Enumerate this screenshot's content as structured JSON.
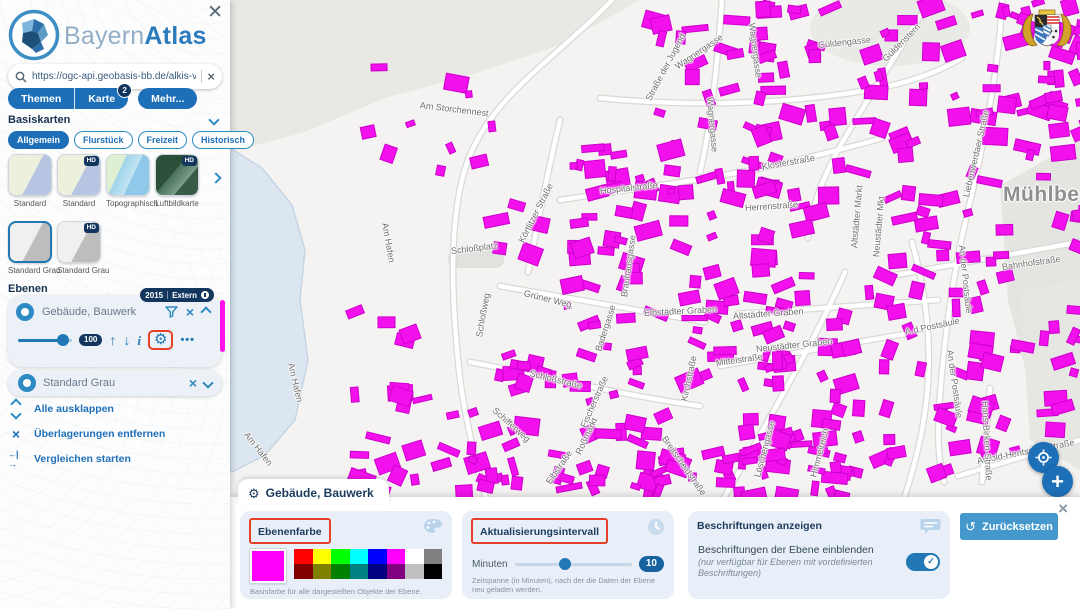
{
  "brand": {
    "bayern": "Bayern",
    "atlas": "Atlas"
  },
  "sidebar": {
    "search": {
      "value": "https://ogc-api.geobasis-bb.de/alkis-verein"
    },
    "tabs": [
      {
        "label": "Themen"
      },
      {
        "label": "Karte",
        "badge": "2"
      },
      {
        "label": "Mehr..."
      }
    ],
    "basiskarten": {
      "title": "Basiskarten",
      "hd": "HD",
      "chips": [
        "Allgemein",
        "Flurstück",
        "Freizeit",
        "Historisch"
      ],
      "thumbs": [
        {
          "label": "Standard"
        },
        {
          "label": "Standard"
        },
        {
          "label": "Topographisch"
        },
        {
          "label": "Luftbildkarte"
        },
        {
          "label": "Standard Grau"
        },
        {
          "label": "Standard Grau"
        }
      ]
    },
    "ebenen": {
      "title": "Ebenen",
      "layer1": {
        "name": "Gebäude, Bauwerk",
        "year": "2015",
        "type": "Extern",
        "opacity": "100"
      },
      "layer2": {
        "name": "Standard Grau"
      },
      "links": [
        {
          "label": "Alle ausklappen"
        },
        {
          "label": "Überlagerungen entfernen"
        },
        {
          "label": "Vergleichen starten"
        }
      ]
    }
  },
  "panel": {
    "tab_title": "Gebäude, Bauwerk",
    "farbe": {
      "title": "Ebenenfarbe",
      "selected_color": "#ff00ff",
      "palette_row1": [
        "#ff0000",
        "#ffff00",
        "#00ff00",
        "#00ffff",
        "#0000ff",
        "#ff00ff",
        "#ffffff",
        "#808080"
      ],
      "palette_row2": [
        "#800000",
        "#808000",
        "#008000",
        "#008080",
        "#000080",
        "#800080",
        "#c0c0c0",
        "#000000"
      ],
      "caption": "Basisfarbe für alle dargestellten Objekte der Ebene."
    },
    "interval": {
      "title": "Aktualisierungsintervall",
      "unit": "Minuten",
      "value": "10",
      "caption": "Zeitspanne (in Minuten), nach der die Daten der Ebene neu geladen werden."
    },
    "labels": {
      "title": "Beschriftungen anzeigen",
      "text": "Beschriftungen der Ebene einblenden",
      "note": "(nur verfügbar für Ebenen mit vordefinierten Beschriftungen)"
    },
    "reset": "Zurücksetzen"
  },
  "map": {
    "building_color": "#f211ec",
    "building_stroke": "#cc00cc",
    "highlight_color": "#e64028",
    "labels": [
      {
        "t": "Am Storchennest",
        "x": 420,
        "y": 100,
        "r": 7
      },
      {
        "t": "Wagnergasse",
        "x": 752,
        "y": 18,
        "r": 83
      },
      {
        "t": "Wagnergasse",
        "x": 676,
        "y": 62,
        "r": -34
      },
      {
        "t": "Wagnergasse",
        "x": 710,
        "y": 92,
        "r": 85
      },
      {
        "t": "Straße der Jugend",
        "x": 648,
        "y": 95,
        "r": -62
      },
      {
        "t": "Güldengasse",
        "x": 818,
        "y": 40,
        "r": -6
      },
      {
        "t": "Güldenstern",
        "x": 884,
        "y": 55,
        "r": -45
      },
      {
        "t": "Liebenwerdaer Straße",
        "x": 966,
        "y": 192,
        "r": -77
      },
      {
        "t": "Klosterstraße",
        "x": 762,
        "y": 162,
        "r": -10
      },
      {
        "t": "Hospitalstraße",
        "x": 600,
        "y": 186,
        "r": -6
      },
      {
        "t": "Herrenstraße",
        "x": 745,
        "y": 203,
        "r": -4
      },
      {
        "t": "Altstädter Markt",
        "x": 854,
        "y": 243,
        "r": -85
      },
      {
        "t": "Neustädter Mkt",
        "x": 876,
        "y": 252,
        "r": -85
      },
      {
        "t": "Körtlitzer Straße",
        "x": 521,
        "y": 237,
        "r": -63
      },
      {
        "t": "Brauhausgasse",
        "x": 624,
        "y": 292,
        "r": -82
      },
      {
        "t": "Mühlberg",
        "x": 1003,
        "y": 183,
        "r": 0,
        "big": true
      },
      {
        "t": "Schloßplatz",
        "x": 451,
        "y": 246,
        "r": -7
      },
      {
        "t": "Am Hafen",
        "x": 385,
        "y": 218,
        "r": 80
      },
      {
        "t": "Am Hafen",
        "x": 291,
        "y": 358,
        "r": 77
      },
      {
        "t": "Am Hafen",
        "x": 246,
        "y": 428,
        "r": 52
      },
      {
        "t": "Grüner Weg",
        "x": 524,
        "y": 288,
        "r": 14
      },
      {
        "t": "Schloßweg",
        "x": 479,
        "y": 332,
        "r": -80
      },
      {
        "t": "Schloßstraße",
        "x": 530,
        "y": 368,
        "r": 14
      },
      {
        "t": "Badergasse",
        "x": 598,
        "y": 346,
        "r": -72
      },
      {
        "t": "Fischerstraße",
        "x": 583,
        "y": 422,
        "r": -66
      },
      {
        "t": "Roßmarkt",
        "x": 578,
        "y": 449,
        "r": -65
      },
      {
        "t": "Schifferweg",
        "x": 494,
        "y": 404,
        "r": 42
      },
      {
        "t": "Elbstraße",
        "x": 548,
        "y": 478,
        "r": -55
      },
      {
        "t": "Kirchstraße",
        "x": 684,
        "y": 396,
        "r": -78
      },
      {
        "t": "Mittelstraße",
        "x": 716,
        "y": 358,
        "r": -8
      },
      {
        "t": "Altstädter Graben",
        "x": 733,
        "y": 311,
        "r": -4
      },
      {
        "t": "Neustädter Graben",
        "x": 756,
        "y": 344,
        "r": -6
      },
      {
        "t": "Elbstädter Graben",
        "x": 644,
        "y": 308,
        "r": -3
      },
      {
        "t": "Löschengasse",
        "x": 757,
        "y": 472,
        "r": -75
      },
      {
        "t": "Himmelreich",
        "x": 813,
        "y": 472,
        "r": -75
      },
      {
        "t": "Breitscheidstraße",
        "x": 664,
        "y": 432,
        "r": 55
      },
      {
        "t": "Bahnhofstraße",
        "x": 1002,
        "y": 262,
        "r": -8
      },
      {
        "t": "An der Postsäule",
        "x": 962,
        "y": 240,
        "r": 84
      },
      {
        "t": "An der Postsäule",
        "x": 950,
        "y": 345,
        "r": 82
      },
      {
        "t": "A.d.Postsäule",
        "x": 905,
        "y": 327,
        "r": -12
      },
      {
        "t": "Arnold-Hentschel-Straße",
        "x": 977,
        "y": 456,
        "r": -11
      },
      {
        "t": "Hans-Birken-Straße",
        "x": 985,
        "y": 396,
        "r": 87
      }
    ],
    "building_zones": [
      {
        "x": 640,
        "y": 0,
        "w": 200,
        "h": 140,
        "n": 40
      },
      {
        "x": 850,
        "y": 0,
        "w": 230,
        "h": 140,
        "n": 45
      },
      {
        "x": 1000,
        "y": 0,
        "w": 80,
        "h": 150,
        "n": 20
      },
      {
        "x": 560,
        "y": 140,
        "w": 300,
        "h": 120,
        "n": 55
      },
      {
        "x": 860,
        "y": 140,
        "w": 150,
        "h": 160,
        "n": 28
      },
      {
        "x": 560,
        "y": 260,
        "w": 280,
        "h": 120,
        "n": 55
      },
      {
        "x": 840,
        "y": 280,
        "w": 140,
        "h": 200,
        "n": 30
      },
      {
        "x": 600,
        "y": 380,
        "w": 260,
        "h": 110,
        "n": 45
      },
      {
        "x": 430,
        "y": 320,
        "w": 170,
        "h": 170,
        "n": 28
      },
      {
        "x": 330,
        "y": 60,
        "w": 160,
        "h": 120,
        "n": 10
      },
      {
        "x": 480,
        "y": 130,
        "w": 120,
        "h": 120,
        "n": 8
      },
      {
        "x": 330,
        "y": 300,
        "w": 100,
        "h": 190,
        "n": 13
      },
      {
        "x": 980,
        "y": 300,
        "w": 100,
        "h": 180,
        "n": 18
      },
      {
        "x": 440,
        "y": 440,
        "w": 180,
        "h": 52,
        "n": 14
      },
      {
        "x": 620,
        "y": 440,
        "w": 220,
        "h": 52,
        "n": 20
      },
      {
        "x": 1000,
        "y": 150,
        "w": 80,
        "h": 90,
        "n": 6
      },
      {
        "x": 340,
        "y": 420,
        "w": 100,
        "h": 72,
        "n": 8
      }
    ]
  }
}
